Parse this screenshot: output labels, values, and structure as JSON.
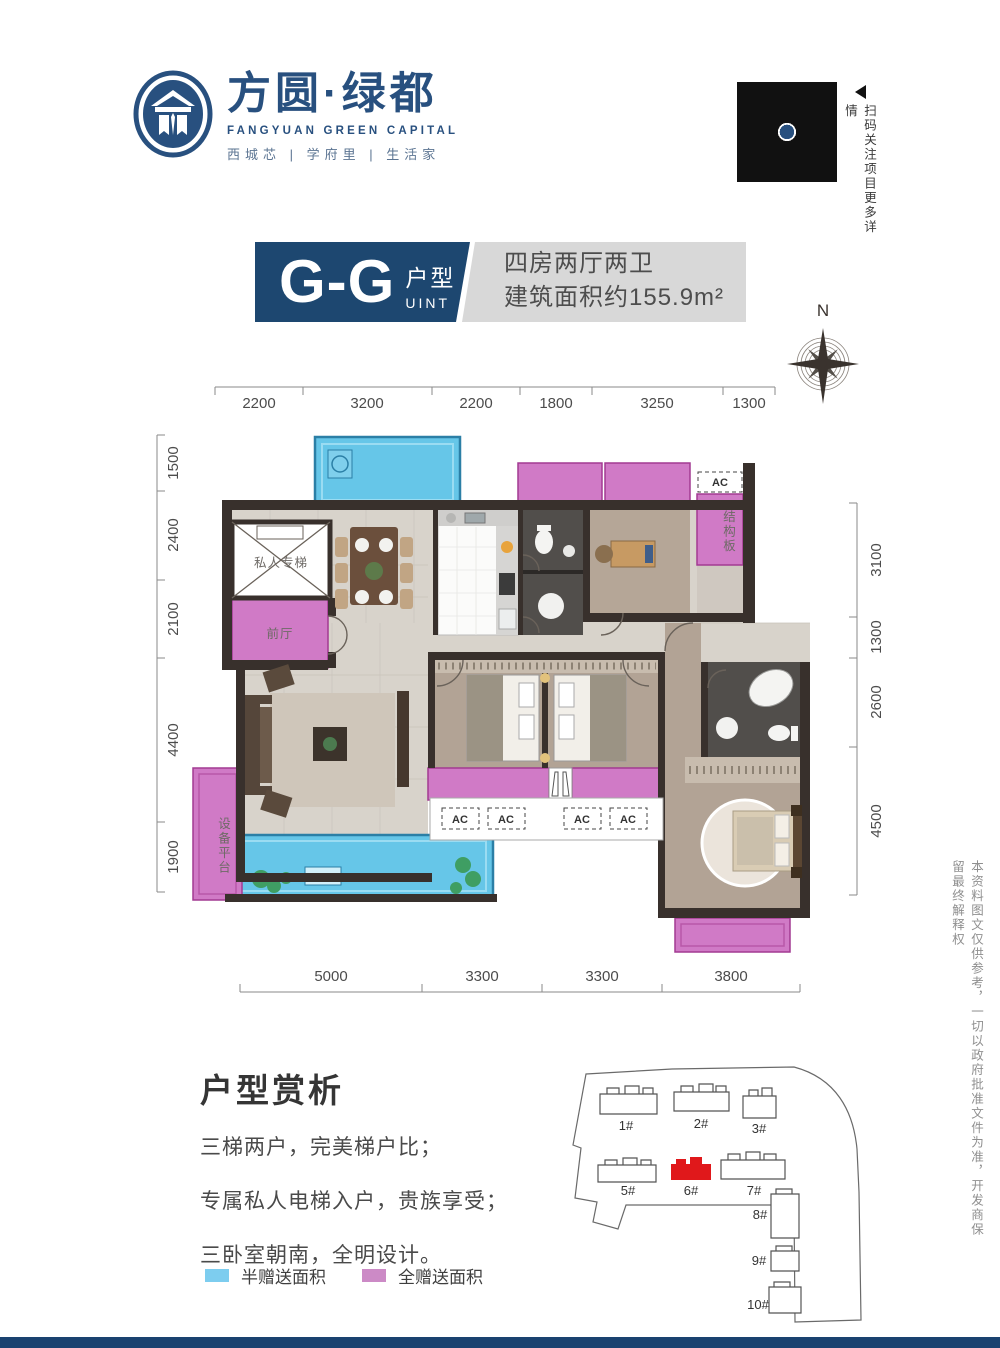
{
  "header": {
    "brand": {
      "title": "方圆·绿都",
      "subtitle": "FANGYUAN GREEN CAPITAL",
      "tagline": "西城芯 | 学府里 | 生活家"
    },
    "qr_caption": "扫码关注项目更多详情"
  },
  "title_block": {
    "unit_code": "G-G",
    "unit_type_cn": "户型",
    "unit_type_en": "UINT",
    "layout": "四房两厅两卫",
    "area": "建筑面积约155.9m²"
  },
  "compass": {
    "north": "N"
  },
  "plan": {
    "dims": {
      "top": [
        "2200",
        "3200",
        "2200",
        "1800",
        "3250",
        "1300"
      ],
      "left": [
        "1500",
        "2400",
        "2100",
        "4400",
        "1900"
      ],
      "right": [
        "3100",
        "1300",
        "2600",
        "4500"
      ],
      "bottom": [
        "5000",
        "3300",
        "3300",
        "3800"
      ]
    },
    "labels": {
      "elevator": "私人专梯",
      "foyer": "前厅",
      "equipment": "设备平台",
      "structure": "结构板",
      "ac": "AC"
    }
  },
  "analysis": {
    "heading": "户型赏析",
    "lines": [
      "三梯两户，完美梯户比；",
      "专属私人电梯入户，贵族享受；",
      "三卧室朝南，全明设计。"
    ]
  },
  "legend": {
    "half": "半赠送面积",
    "full": "全赠送面积"
  },
  "siteplan": {
    "buildings": [
      "1#",
      "2#",
      "3#",
      "5#",
      "6#",
      "7#",
      "8#",
      "9#",
      "10#"
    ]
  },
  "disclaimer": "本资料图文仅供参考，一切以政府批准文件为准，开发商保留最终解释权",
  "colors": {
    "brand_blue": "#28507f",
    "title_navy": "#1d4770",
    "half_gift_blue": "#66c6e8",
    "full_gift_pink": "#d07ac6",
    "legend_blue": "#7dcdef",
    "legend_pink": "#cc8ac6",
    "highlight_red": "#e0181b",
    "footer_navy": "#1a4270"
  }
}
